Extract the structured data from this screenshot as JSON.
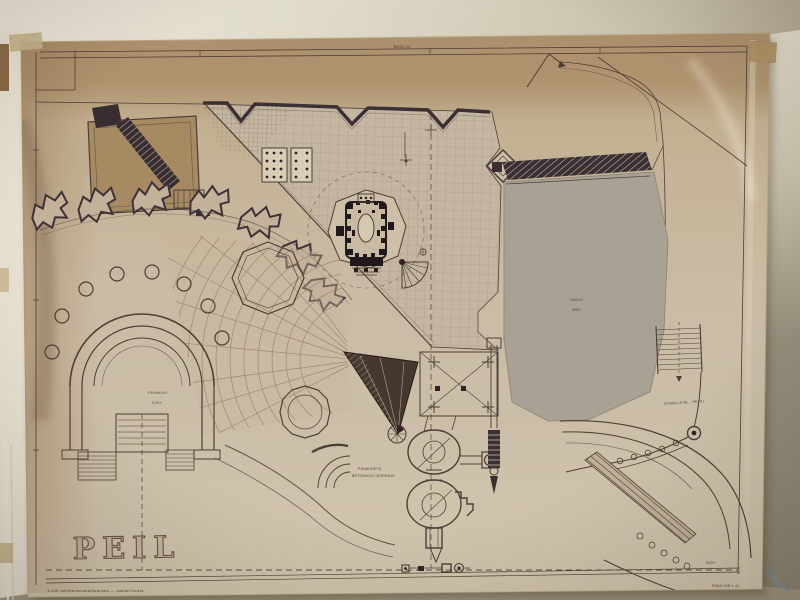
{
  "drawing": {
    "stamp": "PEIL",
    "caption": "1:100   raekttenkonstatlinanseo — vaktab funkia",
    "top_note": "BRAN 25",
    "labels": {
      "arena_name": "PIHAKIVI",
      "arena_level": "220+",
      "terrace_name": "HWVV",
      "terrace_level": "480+",
      "paving_line1": "PIHAKIVEYS",
      "paving_line2": "BETONIKIVI-VERHOUS",
      "stair_note": "OTWALLA ML - HETKI",
      "corner_level": "335+",
      "scale_note": "PANO NIB 1:41"
    },
    "colors": {
      "sheet": "#c9baa2",
      "sheet_shadow_band": "#ab8e6a",
      "ink": "#4d3e37",
      "heavy_ink": "#382e33",
      "terrace_gray": "#a8a294",
      "wall": "#ddd8c8",
      "tape": "#c6b48b"
    }
  }
}
